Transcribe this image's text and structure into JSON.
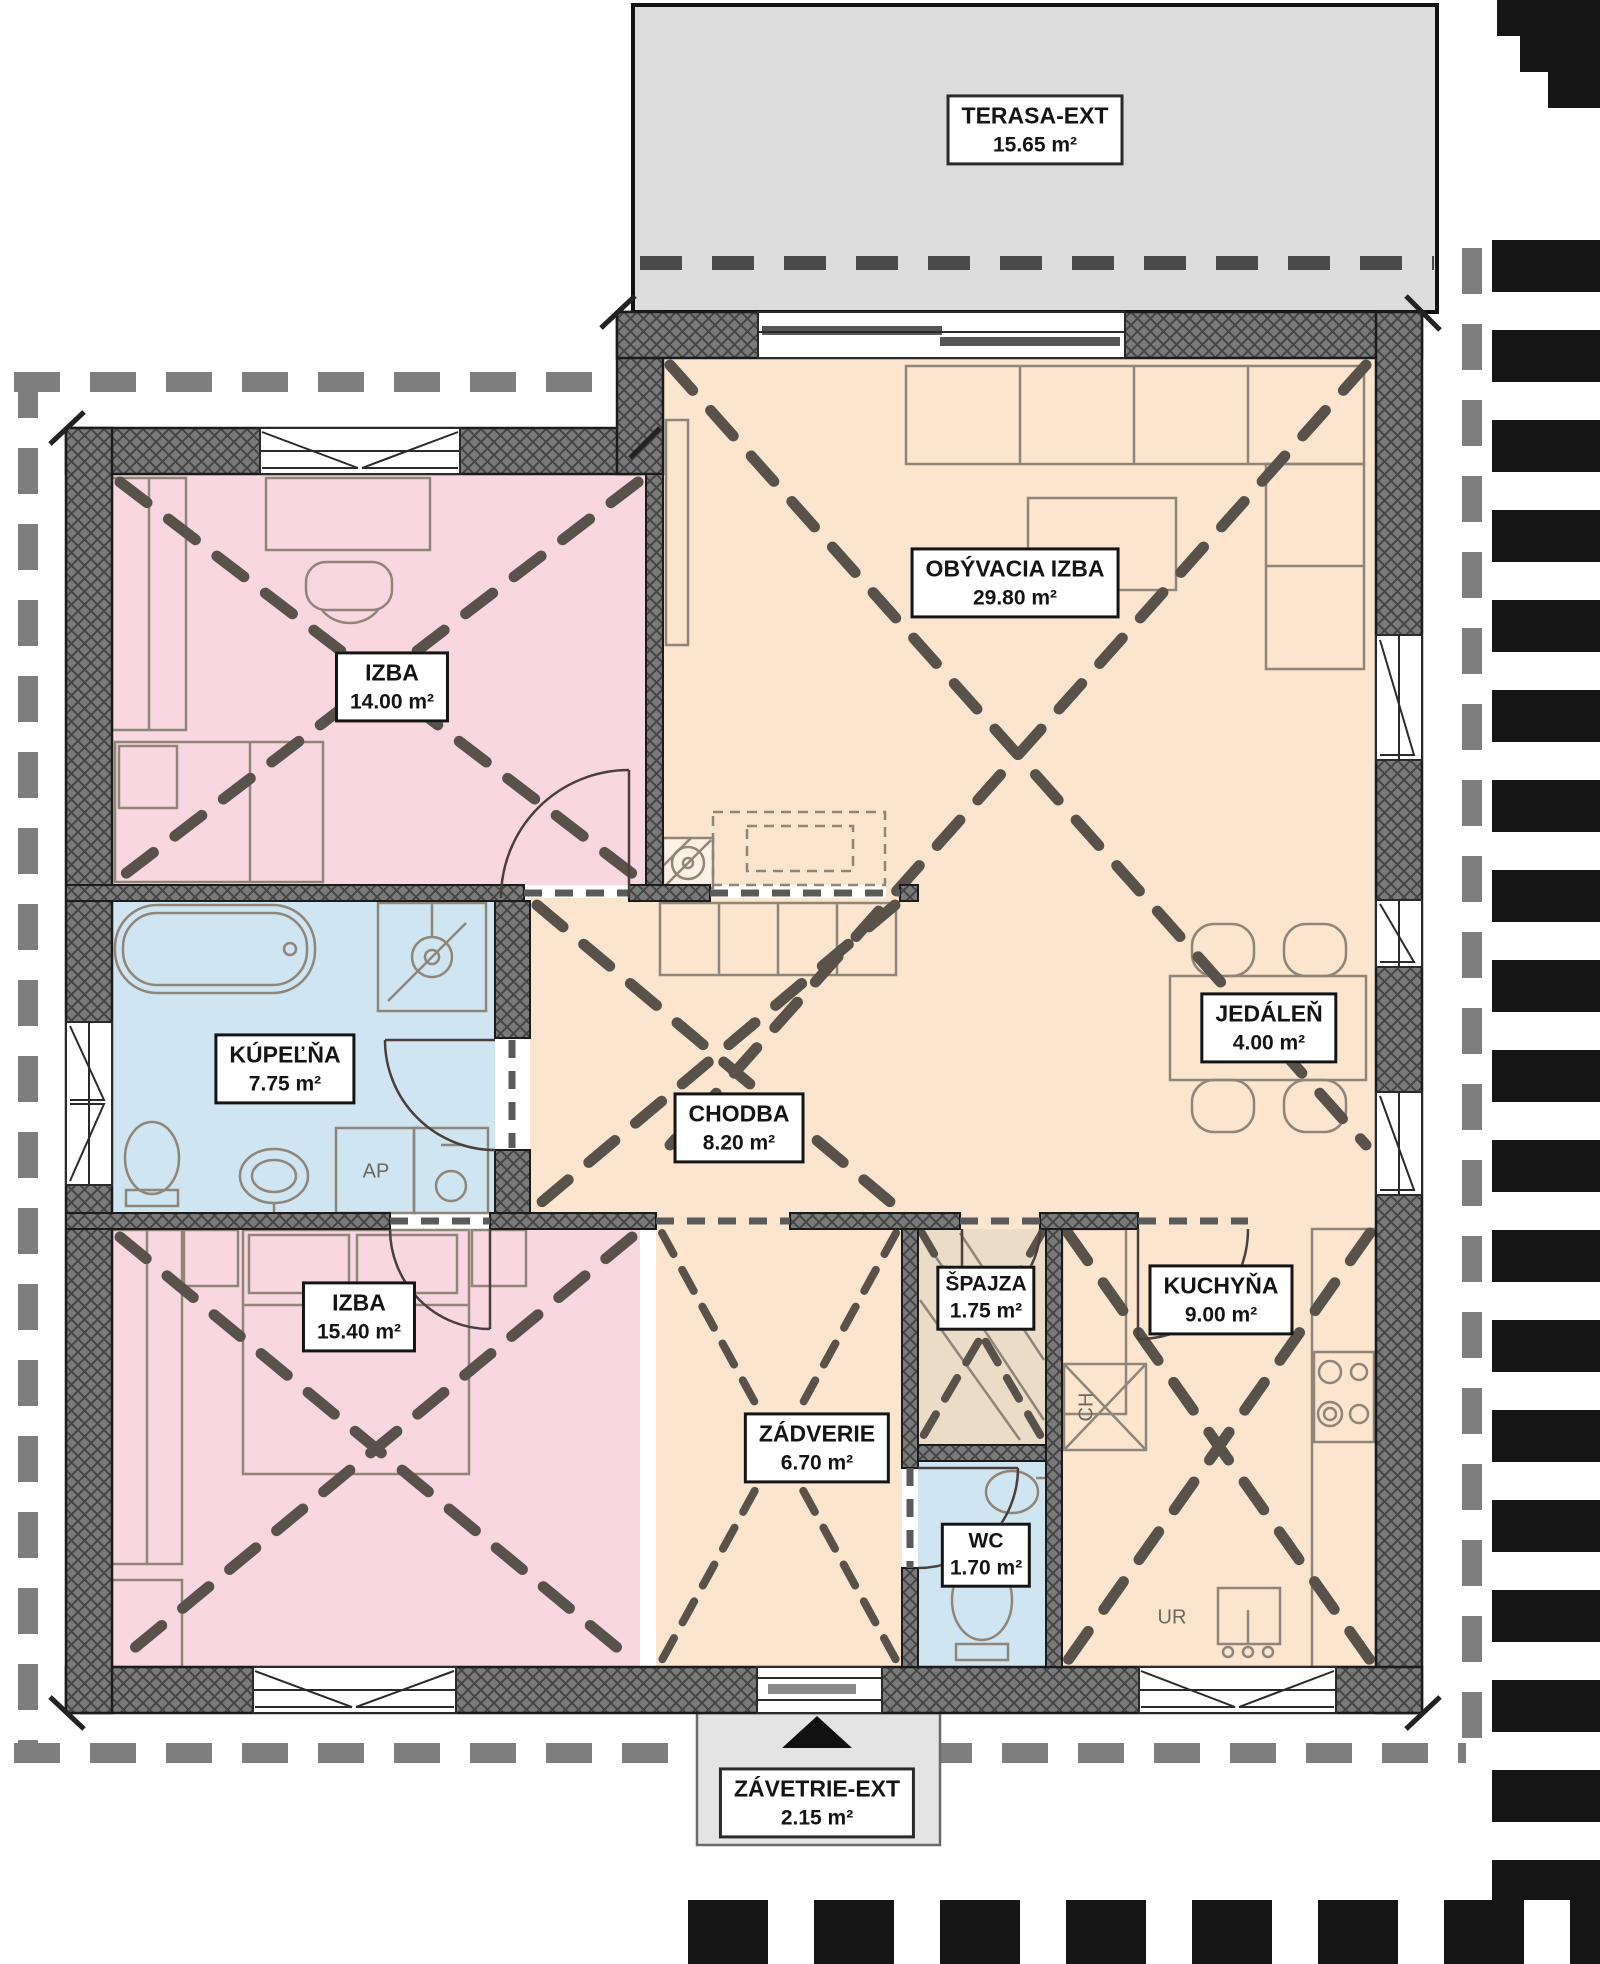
{
  "plan": {
    "title": "floor-plan",
    "rooms": [
      {
        "id": "terasa",
        "name": "TERASA-EXT",
        "area": "15.65 m²"
      },
      {
        "id": "obyvacia",
        "name": "OBÝVACIA IZBA",
        "area": "29.80 m²"
      },
      {
        "id": "izba1",
        "name": "IZBA",
        "area": "14.00 m²"
      },
      {
        "id": "kupelna",
        "name": "KÚPEĽŇA",
        "area": "7.75 m²"
      },
      {
        "id": "chodba",
        "name": "CHODBA",
        "area": "8.20 m²"
      },
      {
        "id": "jedalen",
        "name": "JEDÁLEŇ",
        "area": "4.00 m²"
      },
      {
        "id": "izba2",
        "name": "IZBA",
        "area": "15.40 m²"
      },
      {
        "id": "spajza",
        "name": "ŠPAJZA",
        "area": "1.75 m²"
      },
      {
        "id": "kuchyna",
        "name": "KUCHYŇA",
        "area": "9.00 m²"
      },
      {
        "id": "zadverie",
        "name": "ZÁDVERIE",
        "area": "6.70 m²"
      },
      {
        "id": "wc",
        "name": "WC",
        "area": "1.70 m²"
      },
      {
        "id": "zavetrie",
        "name": "ZÁVETRIE-EXT",
        "area": "2.15 m²"
      }
    ],
    "appliances": [
      {
        "id": "ap",
        "label": "AP"
      },
      {
        "id": "ch",
        "label": "CH"
      },
      {
        "id": "ur",
        "label": "UR"
      }
    ],
    "colors": {
      "room_peach": "#FBE5CF",
      "room_pink": "#F8D7E0",
      "room_blue": "#CFE5F2",
      "room_tan": "#EBDCC8",
      "terrace_gray": "#DCDCDC",
      "zavetrie_gray": "#E4E4E4",
      "wall_gray": "#7A7A7A",
      "dash_brown": "#59524A",
      "roof_gray": "#7E7E7E",
      "edge_black": "#161616"
    }
  }
}
